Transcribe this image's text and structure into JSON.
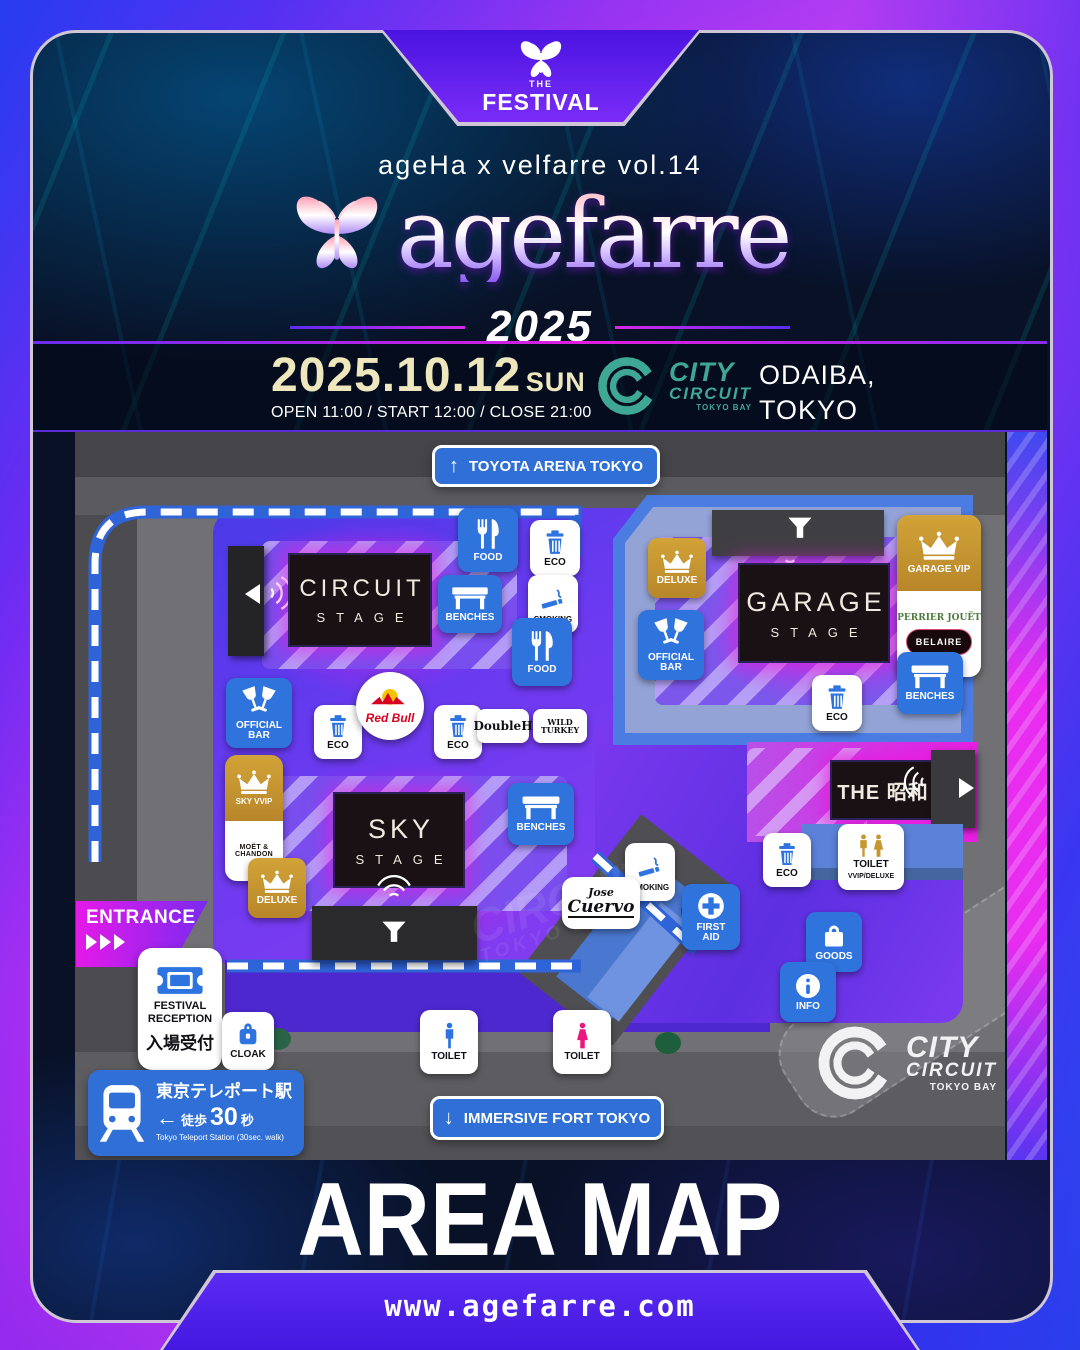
{
  "brand": {
    "the": "THE",
    "festival": "FESTIVAL"
  },
  "header": {
    "subtitle": "ageHa x velfarre vol.14",
    "title": "agefarre",
    "year": "2025",
    "date": "2025.10.12",
    "day": "SUN",
    "times": "OPEN 11:00 / START 12:00 / CLOSE 21:00",
    "location1": "ODAIBA,",
    "location2": "TOKYO"
  },
  "city_circuit": {
    "city": "CITY",
    "circuit": "CIRCUIT",
    "bay": "TOKYO BAY"
  },
  "icons": {
    "up": "↑",
    "down": "↓",
    "left": "←"
  },
  "map": {
    "top_banner": "TOYOTA ARENA TOKYO",
    "bottom_banner": "IMMERSIVE FORT TOKYO",
    "entrance": "ENTRANCE",
    "stages": {
      "circuit1": "CIRCUIT",
      "circuit2": "STAGE",
      "garage1": "GARAGE",
      "garage2": "STAGE",
      "sky1": "SKY",
      "sky2": "STAGE",
      "showa": "THE 昭和"
    },
    "labels": {
      "food": "FOOD",
      "eco": "ECO",
      "benches": "BENCHES",
      "smoking": "SMOKING",
      "official_bar": "OFFICIAL BAR",
      "deluxe": "DELUXE",
      "garage_vip": "GARAGE VIP",
      "sky_vvip": "SKY VVIP",
      "toilet": "TOILET",
      "toilet_sub": "VVIP/DELUXE",
      "cloak": "CLOAK",
      "goods": "GOODS",
      "info": "INFO",
      "first_aid": "FIRST AID"
    },
    "sponsors": {
      "red_bull": "Red Bull",
      "double_h": "DoubleH",
      "wild_turkey": "WILD TURKEY",
      "jose1": "Jose",
      "jose2": "Cuervo",
      "moet": "MOËT & CHANDON",
      "perrier": "PERRIER JOUËT",
      "belaire": "BELAIRE"
    },
    "reception": {
      "l1": "FESTIVAL",
      "l2": "RECEPTION",
      "jp": "入場受付"
    },
    "station": {
      "jp": "東京テレポート駅",
      "walk_pre": "徒歩",
      "walk_num": "30",
      "walk_unit": "秒",
      "en": "Tokyo Teleport Station (30sec. walk)"
    },
    "watermark1": "CIRCUIT",
    "watermark2": "TOKYO BAY"
  },
  "footer": {
    "title": "AREA MAP",
    "website": "www.agefarre.com"
  }
}
